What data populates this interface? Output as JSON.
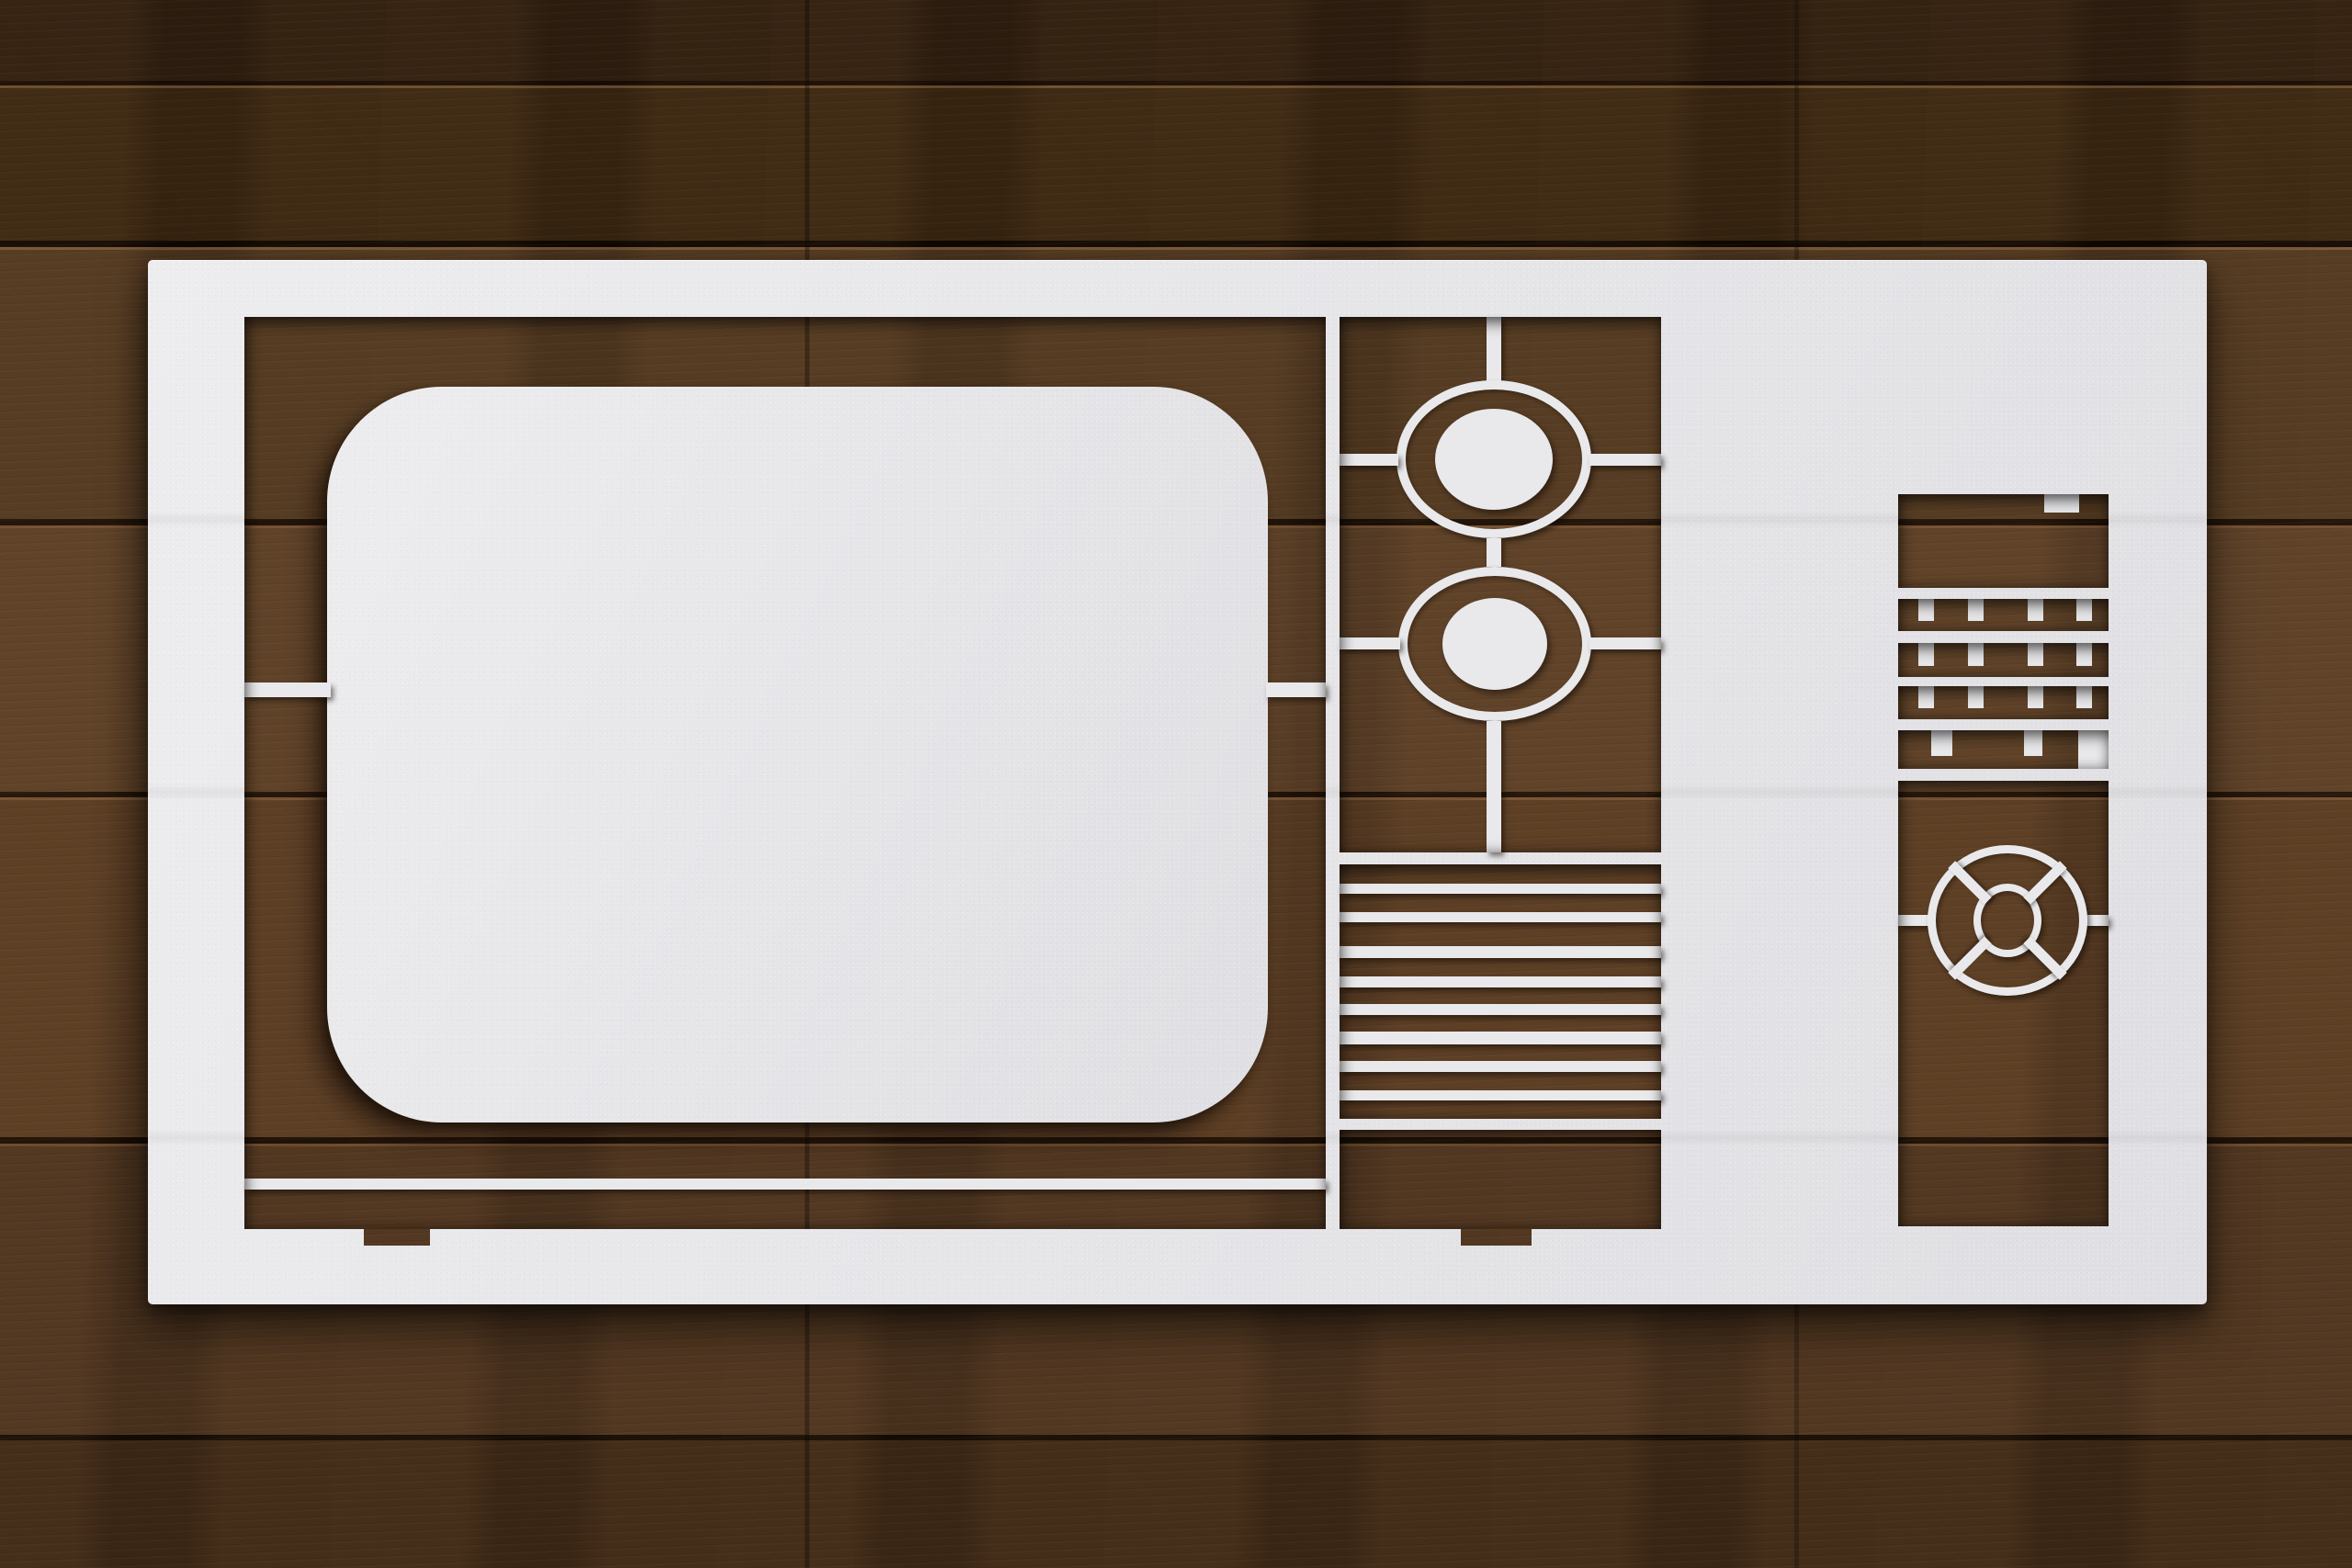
{
  "meta": {
    "type": "photograph",
    "alt": "White retro television stencil cut-out sheet lying on a dark stained wood plank table"
  },
  "palette": {
    "sheet_white": "#e9e9eb",
    "wood_darkest": "#150c04",
    "wood_dark": "#2f1f10",
    "wood_mid": "#533a22",
    "wood_warm": "#6e4c2c",
    "wood_highlight": "#7d5b39",
    "cut_shadow": "rgba(12,6,2,0.5)"
  },
  "scene": {
    "background": "dark brown horizontal wood planks with seams and grain",
    "object": "laser-cut white stencil sheet of a mid-century CRT television",
    "parts": [
      "rounded CRT screen window piece with drop shadow",
      "two concentric tuning-knob rings with center discs and crosshair bars",
      "nine horizontal speaker grille slats",
      "bottom panel with two feet notches",
      "side panel with notched comb grille rows",
      "side panel spoked round dial",
      "connecting bridges between sheet and screen piece"
    ]
  }
}
